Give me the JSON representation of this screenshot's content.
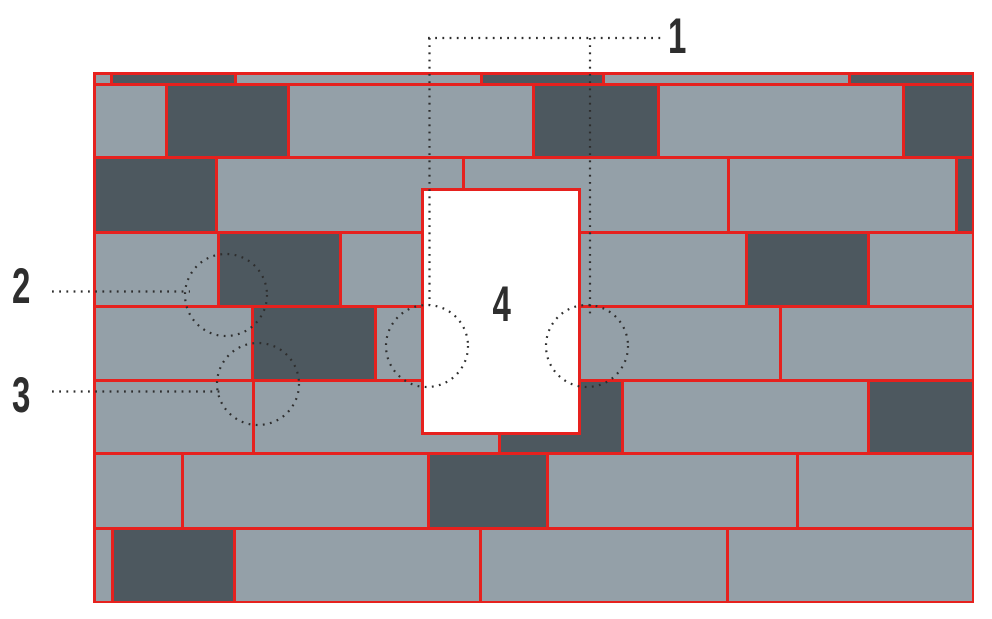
{
  "figure": {
    "kind": "tile-wall-installation-diagram",
    "description_visible_elements": "brick wall pattern with window opening and numbered callouts"
  },
  "colors": {
    "background": "#ffffff",
    "brick_light": "#94a0a8",
    "brick_dark": "#4d585f",
    "mortar_red": "#e6211e",
    "window_fill": "#ffffff",
    "annotation_ink": "#2e2e2e"
  },
  "labels": {
    "one": "1",
    "two": "2",
    "three": "3",
    "four": "4"
  },
  "wall": {
    "x": 94,
    "y": 73,
    "w": 879,
    "h": 529,
    "joint_px": 3
  },
  "window_opening": {
    "x": 421,
    "y": 188,
    "w": 160,
    "h": 247,
    "border_px": 3
  },
  "brick_rows": [
    {
      "y": 73,
      "h": 11,
      "bricks": [
        [
          94,
          17,
          "L"
        ],
        [
          111,
          124,
          "D"
        ],
        [
          235,
          246,
          "L"
        ],
        [
          481,
          122,
          "D"
        ],
        [
          603,
          246,
          "L"
        ],
        [
          849,
          124,
          "D"
        ]
      ]
    },
    {
      "y": 84,
      "h": 73,
      "bricks": [
        [
          94,
          72,
          "L"
        ],
        [
          166,
          122,
          "D"
        ],
        [
          288,
          245,
          "L"
        ],
        [
          533,
          125,
          "D"
        ],
        [
          658,
          245,
          "L"
        ],
        [
          903,
          70,
          "D"
        ]
      ]
    },
    {
      "y": 157,
      "h": 75,
      "bricks": [
        [
          94,
          122,
          "D"
        ],
        [
          216,
          247,
          "L"
        ],
        [
          463,
          265,
          "L"
        ],
        [
          728,
          228,
          "L"
        ],
        [
          956,
          17,
          "D"
        ]
      ]
    },
    {
      "y": 232,
      "h": 74,
      "bricks": [
        [
          94,
          124,
          "L"
        ],
        [
          218,
          122,
          "D"
        ],
        [
          340,
          406,
          "L"
        ],
        [
          746,
          122,
          "D"
        ],
        [
          868,
          105,
          "L"
        ]
      ]
    },
    {
      "y": 306,
      "h": 74,
      "bricks": [
        [
          94,
          158,
          "L"
        ],
        [
          252,
          123,
          "D"
        ],
        [
          375,
          405,
          "L"
        ],
        [
          780,
          193,
          "L"
        ]
      ]
    },
    {
      "y": 380,
      "h": 73,
      "bricks": [
        [
          94,
          159,
          "L"
        ],
        [
          253,
          246,
          "L"
        ],
        [
          499,
          123,
          "D"
        ],
        [
          622,
          246,
          "L"
        ],
        [
          868,
          105,
          "D"
        ]
      ]
    },
    {
      "y": 453,
      "h": 75,
      "bricks": [
        [
          94,
          88,
          "L"
        ],
        [
          182,
          246,
          "L"
        ],
        [
          428,
          119,
          "D"
        ],
        [
          547,
          250,
          "L"
        ],
        [
          797,
          176,
          "L"
        ]
      ]
    },
    {
      "y": 528,
      "h": 74,
      "bricks": [
        [
          94,
          18,
          "L"
        ],
        [
          112,
          122,
          "D"
        ],
        [
          234,
          246,
          "L"
        ],
        [
          480,
          247,
          "L"
        ],
        [
          727,
          246,
          "L"
        ]
      ]
    }
  ],
  "annotations": {
    "lines": [
      {
        "id": "callout1-line-top",
        "orient": "h",
        "x": 428,
        "y": 38,
        "len": 236
      },
      {
        "id": "callout1-line-left",
        "orient": "v",
        "x": 429.5,
        "y": 38,
        "len": 267
      },
      {
        "id": "callout1-line-right",
        "orient": "v",
        "x": 590,
        "y": 38,
        "len": 278
      },
      {
        "id": "callout2-line",
        "orient": "h",
        "x": 52,
        "y": 291.5,
        "len": 138
      },
      {
        "id": "callout3-line",
        "orient": "h",
        "x": 52,
        "y": 391.5,
        "len": 168
      }
    ],
    "circles": [
      {
        "id": "detail-circle-2",
        "cx": 226,
        "cy": 295,
        "r": 41
      },
      {
        "id": "detail-circle-3",
        "cx": 258,
        "cy": 384,
        "r": 41
      },
      {
        "id": "detail-circle-window-left",
        "cx": 427,
        "cy": 346,
        "r": 41
      },
      {
        "id": "detail-circle-window-right",
        "cx": 587,
        "cy": 346,
        "r": 41
      }
    ],
    "labels": [
      {
        "id": "callout-label-1",
        "x": 668,
        "y": 11
      },
      {
        "id": "callout-label-2",
        "x": 12,
        "y": 261
      },
      {
        "id": "callout-label-3",
        "x": 12,
        "y": 370
      }
    ]
  }
}
